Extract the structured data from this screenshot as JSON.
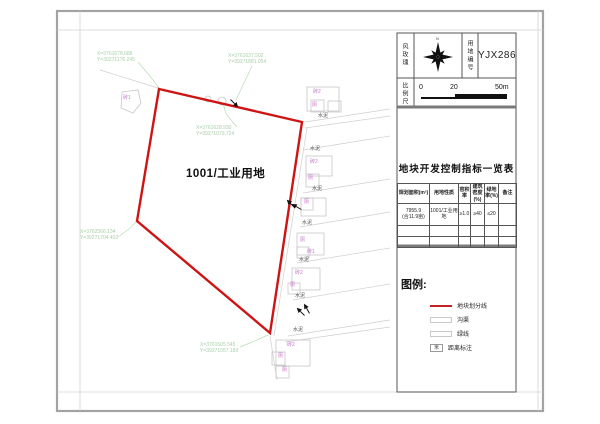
{
  "titleblock": {
    "windrose_label": "风玫瑰",
    "north_label": "N",
    "plot_no_label": "用地编号",
    "plot_no": "YJX286",
    "scale_label": "比例尺",
    "scale_ticks": {
      "t0": "0",
      "t1": "20",
      "t2": "50m"
    }
  },
  "table": {
    "title": "地块开发控制指标一览表",
    "headers": [
      "规划面积(m²)",
      "用地性质",
      "容积率",
      "建筑密度(%)",
      "绿地率(%)",
      "备注"
    ],
    "rows": [
      [
        "7955.9\n(合11.9亩)",
        "1001/工业用地",
        "≥1.0",
        "≥40",
        "≤20",
        ""
      ],
      [
        "",
        "",
        "",
        "",
        "",
        ""
      ],
      [
        "",
        "",
        "",
        "",
        "",
        ""
      ]
    ]
  },
  "legend": {
    "title": "图例:",
    "items": [
      {
        "symbol": "redline",
        "label": "地块划分线"
      },
      {
        "symbol": "rect",
        "label": "沟渠"
      },
      {
        "symbol": "rect",
        "label": "绿线"
      },
      {
        "symbol": "distbox",
        "symbol_text": "米",
        "label": "距离标注"
      }
    ]
  },
  "map": {
    "parcel_label": "1001/工业用地",
    "parcel_points": "159,89 302,122 270,333 137,221",
    "left_structure_points": "122,92 138,90 141,103 133,113 121,108",
    "coord_notes": [
      {
        "x": 97,
        "y": 51,
        "t": "X=3761678.688\nY=39271176.245"
      },
      {
        "x": 228,
        "y": 53,
        "t": "X=3761637.502\nY=39271881.054"
      },
      {
        "x": 196,
        "y": 125,
        "t": "X=3761628.930\nY=39271073.724"
      },
      {
        "x": 80,
        "y": 229,
        "t": "X=3762566.134\nY=39271704.402"
      },
      {
        "x": 200,
        "y": 342,
        "t": "X=3761505.545\nY=39271057.189"
      }
    ],
    "leaders": [
      "138,62 150,76 159,88",
      "252,66 243,85 236,100",
      "237,127 226,114 223,103",
      "118,237 129,229 136,222",
      "240,347 257,340 268,335"
    ],
    "roads": [
      [
        100,
        70,
        158,
        88
      ],
      [
        305,
        122,
        390,
        109
      ],
      [
        305,
        128,
        390,
        116
      ],
      [
        303,
        150,
        390,
        136
      ],
      [
        303,
        193,
        390,
        179
      ],
      [
        300,
        227,
        390,
        212
      ],
      [
        297,
        263,
        390,
        248
      ],
      [
        293,
        300,
        390,
        284
      ],
      [
        288,
        336,
        390,
        320
      ],
      [
        285,
        342,
        390,
        327
      ],
      [
        307,
        128,
        274,
        336
      ],
      [
        270,
        336,
        277,
        380
      ]
    ],
    "buildings": [
      [
        307,
        87,
        32,
        24
      ],
      [
        311,
        100,
        13,
        12
      ],
      [
        328,
        101,
        13,
        11
      ],
      [
        306,
        156,
        26,
        20
      ],
      [
        306,
        174,
        13,
        13
      ],
      [
        301,
        198,
        25,
        18
      ],
      [
        301,
        198,
        12,
        12
      ],
      [
        297,
        233,
        27,
        22
      ],
      [
        297,
        247,
        12,
        11
      ],
      [
        292,
        268,
        28,
        22
      ],
      [
        288,
        283,
        12,
        11
      ],
      [
        276,
        340,
        34,
        26
      ],
      [
        272,
        352,
        13,
        13
      ],
      [
        276,
        366,
        13,
        12
      ]
    ],
    "circles": [
      [
        222,
        101,
        4
      ],
      [
        208,
        99,
        3
      ]
    ],
    "arrows": [
      [
        234,
        103,
        45
      ],
      [
        291,
        204,
        225
      ],
      [
        297,
        207,
        210
      ],
      [
        301,
        312,
        225
      ],
      [
        307,
        309,
        240
      ]
    ],
    "tiny_labels": [
      {
        "t": "砖2",
        "x": 313,
        "y": 90,
        "c": "m"
      },
      {
        "t": "厕",
        "x": 312,
        "y": 103,
        "c": "m"
      },
      {
        "t": "水泥",
        "x": 318,
        "y": 114,
        "c": "k"
      },
      {
        "t": "水泥",
        "x": 310,
        "y": 147,
        "c": "k"
      },
      {
        "t": "砖2",
        "x": 310,
        "y": 160,
        "c": "m"
      },
      {
        "t": "厕",
        "x": 308,
        "y": 176,
        "c": "m"
      },
      {
        "t": "水泥",
        "x": 312,
        "y": 187,
        "c": "k"
      },
      {
        "t": "厕",
        "x": 304,
        "y": 200,
        "c": "m"
      },
      {
        "t": "水泥",
        "x": 302,
        "y": 221,
        "c": "k"
      },
      {
        "t": "厕",
        "x": 300,
        "y": 238,
        "c": "m"
      },
      {
        "t": "砖1",
        "x": 307,
        "y": 250,
        "c": "m"
      },
      {
        "t": "水泥",
        "x": 299,
        "y": 258,
        "c": "k"
      },
      {
        "t": "砖2",
        "x": 295,
        "y": 271,
        "c": "m"
      },
      {
        "t": "厕",
        "x": 290,
        "y": 283,
        "c": "m"
      },
      {
        "t": "水泥",
        "x": 295,
        "y": 294,
        "c": "k"
      },
      {
        "t": "水泥",
        "x": 293,
        "y": 328,
        "c": "k"
      },
      {
        "t": "砖2",
        "x": 287,
        "y": 343,
        "c": "m"
      },
      {
        "t": "厕",
        "x": 278,
        "y": 354,
        "c": "m"
      },
      {
        "t": "厕",
        "x": 282,
        "y": 368,
        "c": "m"
      },
      {
        "t": "砖1",
        "x": 123,
        "y": 96,
        "c": "m"
      }
    ]
  }
}
